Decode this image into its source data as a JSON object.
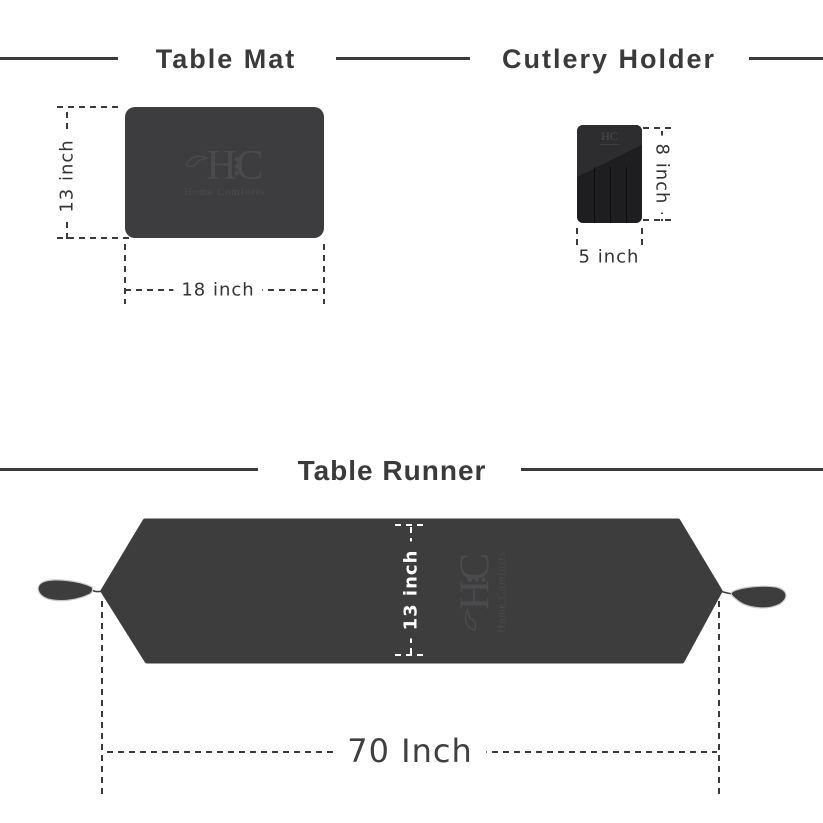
{
  "page": {
    "background": "#ffffff"
  },
  "colors": {
    "header_text": "#3a3a3a",
    "header_line": "#3a3a3a",
    "dimension_text": "#333333",
    "mat_fill": "#3d3d3f",
    "holder_fill": "#1e1e20",
    "holder_highlight": "#2d2d2f",
    "runner_fill": "#3d3d3d",
    "white_dimension_text": "#ffffff",
    "logo_tint": "#4b4b4e",
    "tassel_outline": "#c9c9c9"
  },
  "brand": {
    "h": "H",
    "c": "C",
    "initials": "HC",
    "name": "Home Comforts",
    "ornament": "◆◆◆"
  },
  "sections": {
    "table_mat": {
      "title": "Table Mat",
      "height_label": "13 inch",
      "width_label": "18 inch"
    },
    "cutlery_holder": {
      "title": "Cutlery Holder",
      "height_label": "8 inch",
      "width_label": "5 inch"
    },
    "table_runner": {
      "title": "Table Runner",
      "height_label": "13 inch",
      "width_label": "70 Inch"
    }
  }
}
